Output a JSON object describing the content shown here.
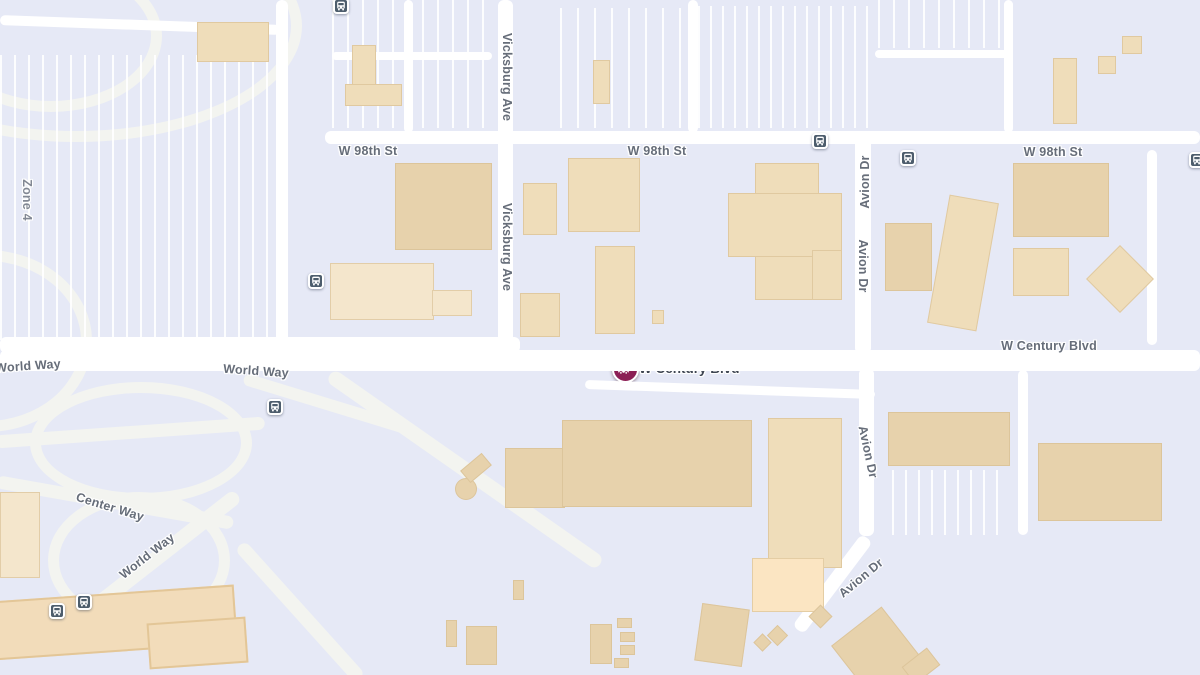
{
  "map": {
    "colors": {
      "background": "#e6e9f6",
      "road_major": "#ffffff",
      "road_ramp": "#f3f4f0",
      "building": "#efddba",
      "building_dark": "#e7d2ac",
      "building_peach": "#fbe5c2",
      "terminal": "#f2dcba",
      "label_text": "#666d79",
      "marker_bg": "#8c1f55",
      "transit_bg": "#4d5d6c"
    },
    "marker": {
      "x": 625,
      "y": 369,
      "label": "W Century Blvd",
      "icon": "car-crash-icon"
    },
    "labels": [
      {
        "text": "W 98th St",
        "x": 368,
        "y": 151,
        "rot": 0
      },
      {
        "text": "W 98th St",
        "x": 657,
        "y": 151,
        "rot": 0
      },
      {
        "text": "W 98th St",
        "x": 1053,
        "y": 152,
        "rot": 0
      },
      {
        "text": "Vicksburg Ave",
        "x": 507,
        "y": 77,
        "rot": 90
      },
      {
        "text": "Vicksburg Ave",
        "x": 507,
        "y": 247,
        "rot": 90
      },
      {
        "text": "Avion Dr",
        "x": 865,
        "y": 182,
        "rot": -90
      },
      {
        "text": "Avion Dr",
        "x": 863,
        "y": 266,
        "rot": 90
      },
      {
        "text": "Avion Dr",
        "x": 868,
        "y": 452,
        "rot": 78
      },
      {
        "text": "Avion Dr",
        "x": 861,
        "y": 578,
        "rot": -40
      },
      {
        "text": "W Century Blvd",
        "x": 1049,
        "y": 346,
        "rot": 0
      },
      {
        "text": "World Way",
        "x": 28,
        "y": 366,
        "rot": -4
      },
      {
        "text": "World Way",
        "x": 256,
        "y": 371,
        "rot": 4
      },
      {
        "text": "Center Way",
        "x": 110,
        "y": 507,
        "rot": 17
      },
      {
        "text": "World Way",
        "x": 147,
        "y": 556,
        "rot": -38
      },
      {
        "text": "Zone 4",
        "x": 27,
        "y": 200,
        "rot": 90,
        "zone": true
      }
    ],
    "transit_stops": [
      {
        "x": 341,
        "y": 6
      },
      {
        "x": 316,
        "y": 281
      },
      {
        "x": 820,
        "y": 141
      },
      {
        "x": 908,
        "y": 158
      },
      {
        "x": 1197,
        "y": 160
      },
      {
        "x": 275,
        "y": 407
      },
      {
        "x": 84,
        "y": 602
      },
      {
        "x": 57,
        "y": 611
      }
    ],
    "roads": [
      {
        "x": 276,
        "y": 0,
        "w": 12,
        "h": 352
      },
      {
        "x": 325,
        "y": 131,
        "w": 875,
        "h": 13
      },
      {
        "x": 498,
        "y": 0,
        "w": 15,
        "h": 352
      },
      {
        "x": 855,
        "y": 138,
        "w": 16,
        "h": 216
      },
      {
        "x": 0,
        "y": 350,
        "w": 1200,
        "h": 21
      },
      {
        "x": 0,
        "y": 337,
        "w": 520,
        "h": 16
      },
      {
        "x": 585,
        "y": 385,
        "w": 290,
        "h": 9,
        "rot": 2
      },
      {
        "x": 859,
        "y": 368,
        "w": 15,
        "h": 168
      },
      {
        "x": 775,
        "y": 577,
        "w": 115,
        "h": 14,
        "rot": -53
      },
      {
        "x": 688,
        "y": 0,
        "w": 10,
        "h": 133
      },
      {
        "x": 404,
        "y": 0,
        "w": 9,
        "h": 133
      },
      {
        "x": 332,
        "y": 52,
        "w": 160,
        "h": 8
      },
      {
        "x": 875,
        "y": 50,
        "w": 135,
        "h": 8
      },
      {
        "x": 1004,
        "y": 0,
        "w": 9,
        "h": 133
      },
      {
        "x": 1147,
        "y": 150,
        "w": 10,
        "h": 195
      },
      {
        "x": 1018,
        "y": 370,
        "w": 10,
        "h": 165
      },
      {
        "x": 0,
        "y": 20,
        "w": 280,
        "h": 10,
        "rot": 2
      }
    ],
    "ramps": [
      {
        "x": 300,
        "y": 462,
        "w": 330,
        "h": 15,
        "rot": 35
      },
      {
        "x": 210,
        "y": 605,
        "w": 180,
        "h": 14,
        "rot": 48
      },
      {
        "x": -5,
        "y": 496,
        "w": 240,
        "h": 13,
        "rot": 10
      },
      {
        "x": 50,
        "y": 552,
        "w": 210,
        "h": 15,
        "rot": -38
      },
      {
        "x": -5,
        "y": 426,
        "w": 270,
        "h": 13,
        "rot": -4
      },
      {
        "x": 240,
        "y": 399,
        "w": 180,
        "h": 12,
        "rot": 17
      }
    ],
    "rings": [
      {
        "x": 30,
        "y": 382,
        "w": 200,
        "h": 100
      },
      {
        "x": 48,
        "y": 492,
        "w": 160,
        "h": 115
      },
      {
        "x": -150,
        "y": -90,
        "w": 430,
        "h": 210
      },
      {
        "x": -120,
        "y": 250,
        "w": 190,
        "h": 160
      },
      {
        "x": -60,
        "y": -40,
        "w": 200,
        "h": 130
      }
    ],
    "parking_lots": [
      {
        "x": 0,
        "y": 55,
        "w": 275,
        "h": 285,
        "gap": 14
      },
      {
        "x": 332,
        "y": 0,
        "w": 160,
        "h": 128,
        "gap": 15
      },
      {
        "x": 560,
        "y": 8,
        "w": 122,
        "h": 120,
        "gap": 17
      },
      {
        "x": 698,
        "y": 6,
        "w": 172,
        "h": 122,
        "gap": 12
      },
      {
        "x": 878,
        "y": 0,
        "w": 125,
        "h": 48,
        "gap": 15
      },
      {
        "x": 892,
        "y": 470,
        "w": 115,
        "h": 65,
        "gap": 13
      }
    ],
    "buildings": [
      {
        "x": 197,
        "y": 22,
        "w": 70,
        "h": 38
      },
      {
        "x": 345,
        "y": 84,
        "w": 55,
        "h": 20
      },
      {
        "x": 352,
        "y": 45,
        "w": 22,
        "h": 38
      },
      {
        "x": 395,
        "y": 163,
        "w": 95,
        "h": 85,
        "shade": "dark"
      },
      {
        "x": 330,
        "y": 263,
        "w": 102,
        "h": 55,
        "shade": "light"
      },
      {
        "x": 432,
        "y": 290,
        "w": 38,
        "h": 24,
        "shade": "light"
      },
      {
        "x": 523,
        "y": 183,
        "w": 32,
        "h": 50
      },
      {
        "x": 520,
        "y": 293,
        "w": 38,
        "h": 42
      },
      {
        "x": 568,
        "y": 158,
        "w": 70,
        "h": 72
      },
      {
        "x": 595,
        "y": 246,
        "w": 38,
        "h": 86
      },
      {
        "x": 652,
        "y": 310,
        "w": 10,
        "h": 12
      },
      {
        "x": 593,
        "y": 60,
        "w": 15,
        "h": 42
      },
      {
        "x": 755,
        "y": 163,
        "w": 62,
        "h": 135
      },
      {
        "x": 728,
        "y": 193,
        "w": 112,
        "h": 62
      },
      {
        "x": 812,
        "y": 250,
        "w": 28,
        "h": 48
      },
      {
        "x": 885,
        "y": 223,
        "w": 45,
        "h": 66,
        "shade": "dark"
      },
      {
        "x": 938,
        "y": 198,
        "w": 48,
        "h": 128,
        "rot": 10
      },
      {
        "x": 1013,
        "y": 163,
        "w": 94,
        "h": 72,
        "shade": "dark"
      },
      {
        "x": 1013,
        "y": 248,
        "w": 54,
        "h": 46
      },
      {
        "x": 1096,
        "y": 255,
        "w": 46,
        "h": 46,
        "rot": 45
      },
      {
        "x": 1053,
        "y": 58,
        "w": 22,
        "h": 64
      },
      {
        "x": 1098,
        "y": 56,
        "w": 16,
        "h": 16
      },
      {
        "x": 1122,
        "y": 36,
        "w": 18,
        "h": 16
      },
      {
        "x": 505,
        "y": 448,
        "w": 58,
        "h": 58,
        "shade": "dark"
      },
      {
        "x": 562,
        "y": 420,
        "w": 188,
        "h": 85,
        "shade": "dark"
      },
      {
        "x": 768,
        "y": 418,
        "w": 72,
        "h": 148
      },
      {
        "x": 752,
        "y": 558,
        "w": 70,
        "h": 52,
        "shade": "peach"
      },
      {
        "x": 888,
        "y": 412,
        "w": 120,
        "h": 52,
        "shade": "dark"
      },
      {
        "x": 1038,
        "y": 443,
        "w": 122,
        "h": 76,
        "shade": "dark"
      },
      {
        "x": 0,
        "y": 492,
        "w": 38,
        "h": 84,
        "shade": "light"
      },
      {
        "x": 455,
        "y": 478,
        "w": 20,
        "h": 20,
        "shade": "dark",
        "round": true
      },
      {
        "x": 462,
        "y": 460,
        "w": 26,
        "h": 14,
        "rot": -40,
        "shade": "dark"
      },
      {
        "x": 513,
        "y": 580,
        "w": 9,
        "h": 18,
        "shade": "dark"
      },
      {
        "x": 446,
        "y": 620,
        "w": 9,
        "h": 25,
        "shade": "dark"
      },
      {
        "x": 466,
        "y": 626,
        "w": 29,
        "h": 37,
        "shade": "dark"
      },
      {
        "x": 590,
        "y": 624,
        "w": 20,
        "h": 38,
        "shade": "dark"
      },
      {
        "x": 617,
        "y": 618,
        "w": 13,
        "h": 8,
        "shade": "dark"
      },
      {
        "x": 620,
        "y": 632,
        "w": 13,
        "h": 8,
        "shade": "dark"
      },
      {
        "x": 620,
        "y": 645,
        "w": 13,
        "h": 8,
        "shade": "dark"
      },
      {
        "x": 614,
        "y": 658,
        "w": 13,
        "h": 8,
        "shade": "dark"
      },
      {
        "x": 698,
        "y": 606,
        "w": 46,
        "h": 56,
        "rot": 8,
        "shade": "dark"
      },
      {
        "x": 756,
        "y": 636,
        "w": 11,
        "h": 11,
        "rot": 45,
        "shade": "dark"
      },
      {
        "x": 770,
        "y": 628,
        "w": 13,
        "h": 13,
        "rot": 45,
        "shade": "dark"
      },
      {
        "x": 812,
        "y": 608,
        "w": 15,
        "h": 15,
        "rot": 45,
        "shade": "dark"
      },
      {
        "x": 848,
        "y": 618,
        "w": 62,
        "h": 75,
        "rot": -38,
        "shade": "dark"
      },
      {
        "x": 905,
        "y": 655,
        "w": 30,
        "h": 20,
        "rot": -38,
        "shade": "dark"
      },
      {
        "x": -8,
        "y": 593,
        "w": 240,
        "h": 55,
        "rot": -4,
        "shade": "terminal"
      },
      {
        "x": 148,
        "y": 620,
        "w": 95,
        "h": 42,
        "rot": -4,
        "shade": "terminal"
      }
    ]
  }
}
